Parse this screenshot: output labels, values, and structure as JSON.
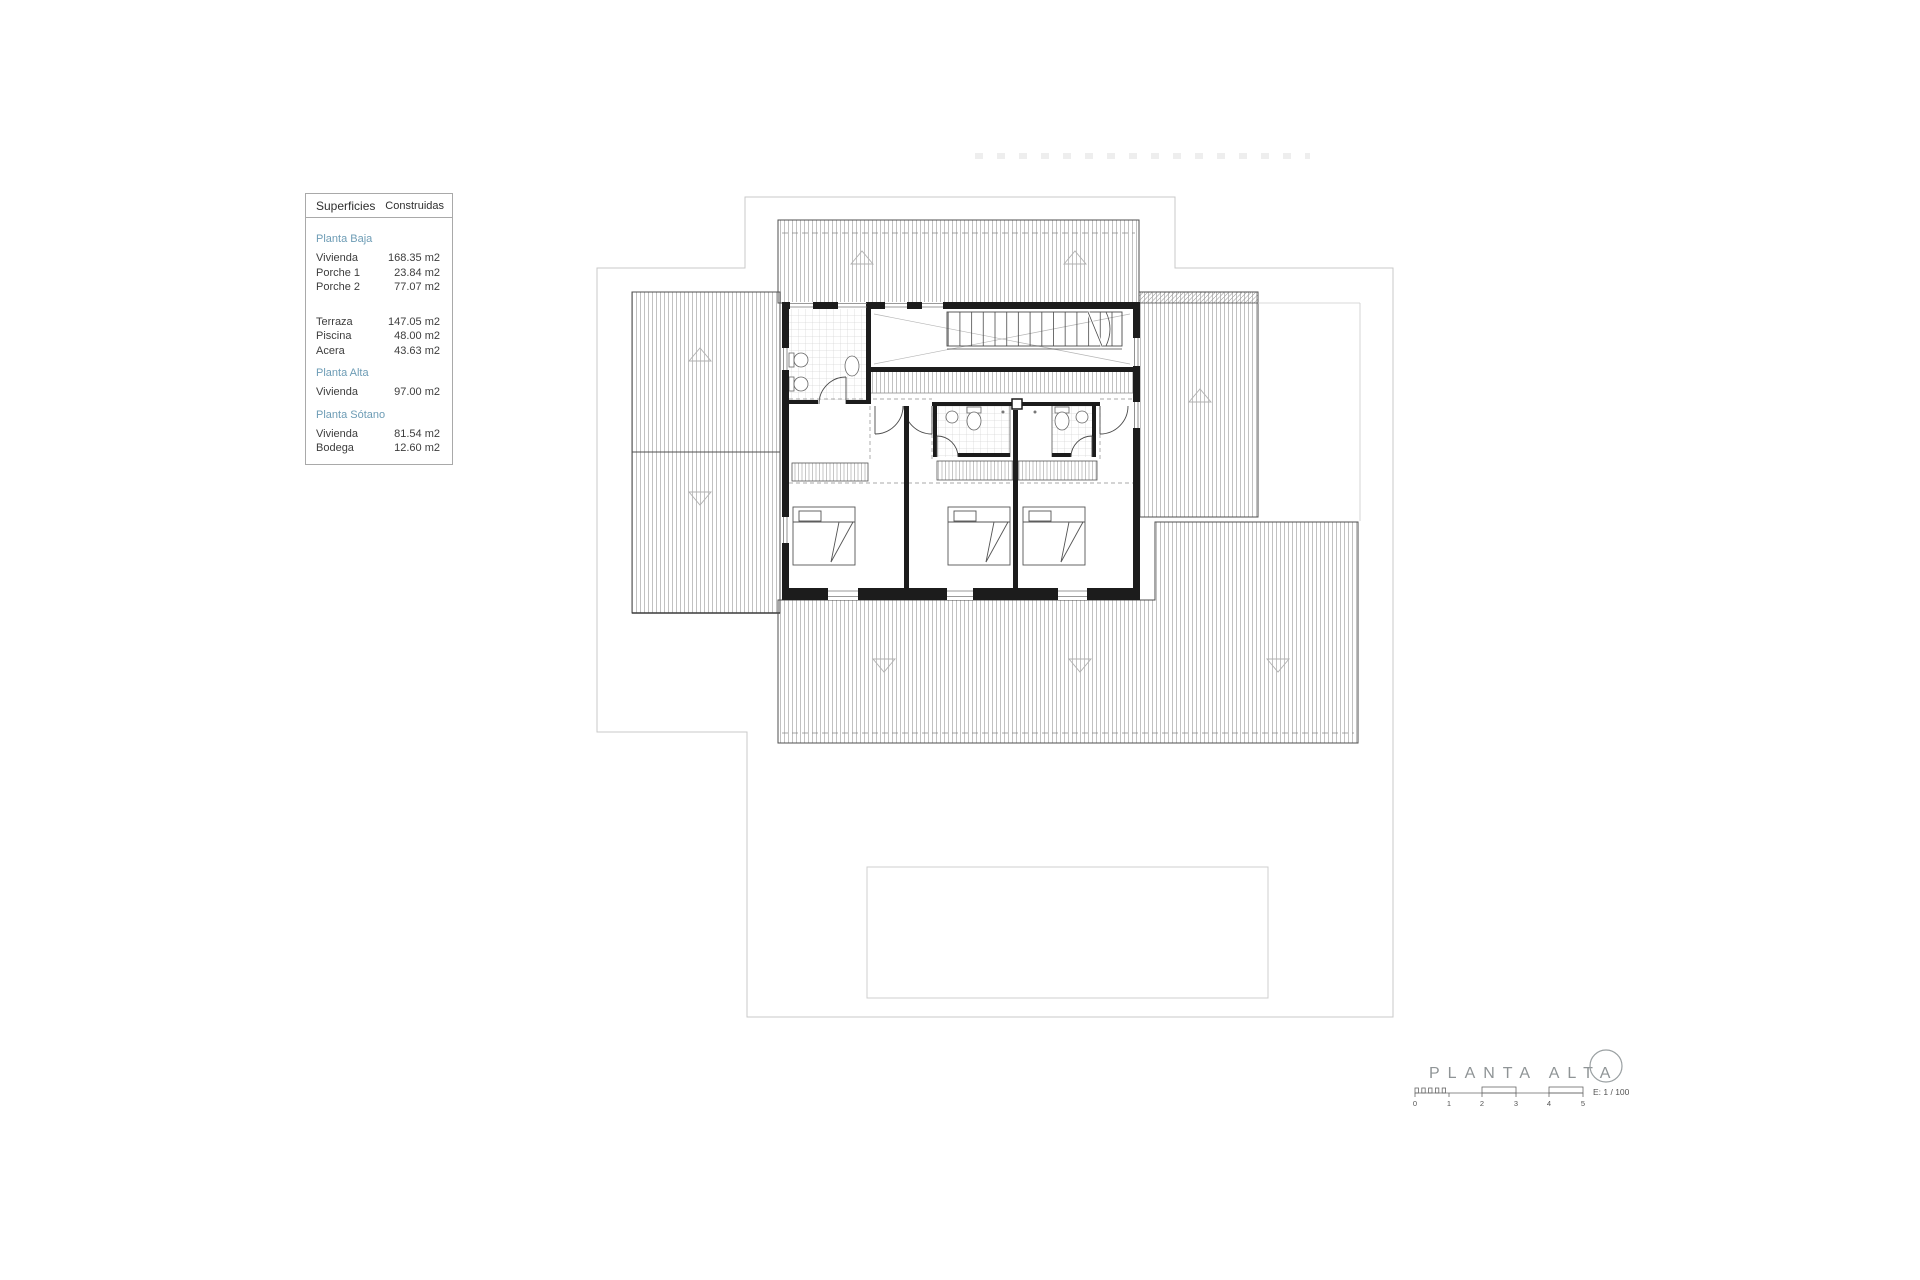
{
  "table": {
    "header": {
      "col1": "Superficies",
      "col2": "Construidas"
    },
    "sections": [
      {
        "title": "Planta Baja",
        "rows": [
          {
            "label": "Vivienda",
            "value": "168.35 m2"
          },
          {
            "label": "Porche 1",
            "value": "23.84 m2"
          },
          {
            "label": "Porche 2",
            "value": "77.07 m2"
          }
        ]
      },
      {
        "title": "",
        "rows": [
          {
            "label": "Terraza",
            "value": "147.05 m2"
          },
          {
            "label": "Piscina",
            "value": "48.00 m2"
          },
          {
            "label": "Acera",
            "value": "43.63 m2"
          }
        ]
      },
      {
        "title": "Planta Alta",
        "rows": [
          {
            "label": "Vivienda",
            "value": "97.00 m2"
          }
        ]
      },
      {
        "title": "Planta Sótano",
        "rows": [
          {
            "label": "Vivienda",
            "value": "81.54 m2"
          },
          {
            "label": "Bodega",
            "value": "12.60 m2"
          }
        ]
      }
    ]
  },
  "titleblock": {
    "title": "PLANTA ALTA",
    "scale_label": "E: 1 / 100",
    "scale_ticks": [
      "0",
      "1",
      "2",
      "3",
      "4",
      "5"
    ]
  },
  "icons": {
    "north_symbol": "circle-outline",
    "roof_slope_up": "triangle-up",
    "roof_slope_down": "triangle-down"
  },
  "colors": {
    "accent_teal": "#6d9cb5",
    "wall": "#1c1c1c",
    "hatch": "#a3a3a3",
    "boundary": "#c9c9c9",
    "title_gray": "#8f9496"
  }
}
